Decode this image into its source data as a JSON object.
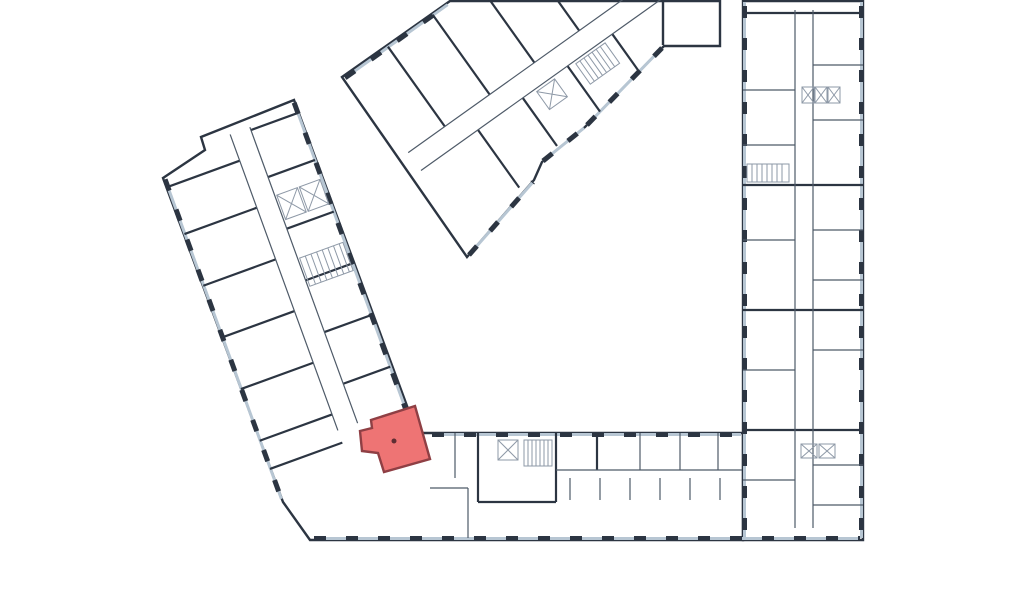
{
  "floor_plan": {
    "background": "#ffffff",
    "colors": {
      "wall": "#2c3542",
      "wall_thin": "#4e5a68",
      "glazing": "#b7c6d3",
      "hatch": "#8e99a7"
    },
    "selected_unit": {
      "id": "selected-apartment",
      "state": "selected",
      "fill": "#ee7474",
      "border": "#8f3f44",
      "marker_color": "#5f2e33"
    },
    "wings": [
      {
        "id": "left-wing"
      },
      {
        "id": "top-wing"
      },
      {
        "id": "right-wing"
      },
      {
        "id": "bottom-wing"
      }
    ]
  }
}
